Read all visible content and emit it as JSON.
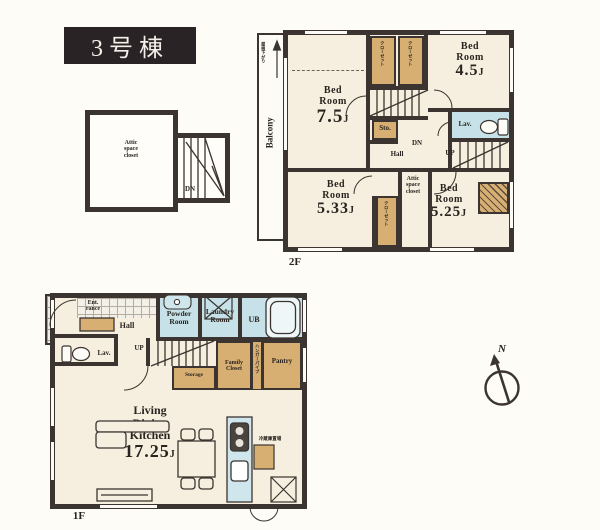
{
  "title": {
    "label": "3号棟"
  },
  "attic": {
    "name_l1": "Attic",
    "name_l2": "space",
    "name_l3": "closet",
    "dn": "DN"
  },
  "f2": {
    "floor_label": "2F",
    "balcony_label": "Balcony",
    "roof_note": "屋根下がり",
    "b75": {
      "l1": "Bed",
      "l2": "Room",
      "num": "7.5",
      "unit": "J"
    },
    "b45": {
      "l1": "Bed",
      "l2": "Room",
      "num": "4.5",
      "unit": "J"
    },
    "b533": {
      "l1": "Bed",
      "l2": "Room",
      "num": "5.33",
      "unit": "J"
    },
    "b525": {
      "l1": "Bed",
      "l2": "Room",
      "num": "5.25",
      "unit": "J"
    },
    "lav": "Lav.",
    "sto": "Sto.",
    "hall": "Hall",
    "dn": "DN",
    "up": "UP",
    "attic_l1": "Attic",
    "attic_l2": "space",
    "attic_l3": "closet",
    "closet_note": "クローゼット"
  },
  "f1": {
    "floor_label": "1F",
    "ent_l1": "Ent.",
    "ent_l2": "rance",
    "hall": "Hall",
    "lav": "Lav.",
    "up": "UP",
    "powder_l1": "Powder",
    "powder_l2": "Room",
    "laundry_l1": "Laundry",
    "laundry_l2": "Room",
    "ub": "UB",
    "storage": "Storage",
    "family_l1": "Family",
    "family_l2": "Closet",
    "hanger_note": "ハンガーパイプ",
    "pantry": "Pantry",
    "ldk_l1": "Living",
    "ldk_l2": "Dining",
    "ldk_l3": "Kitchen",
    "ldk_num": "17.25",
    "ldk_unit": "J",
    "fridge_note": "冷蔵庫置場"
  },
  "compass": {
    "north": "N"
  },
  "colors": {
    "wall": "#3b3430",
    "room_fill": "#f6efdf",
    "closet_fill": "#d7af72",
    "wet_fill": "#c6e2e8",
    "title_bg": "#292325"
  }
}
